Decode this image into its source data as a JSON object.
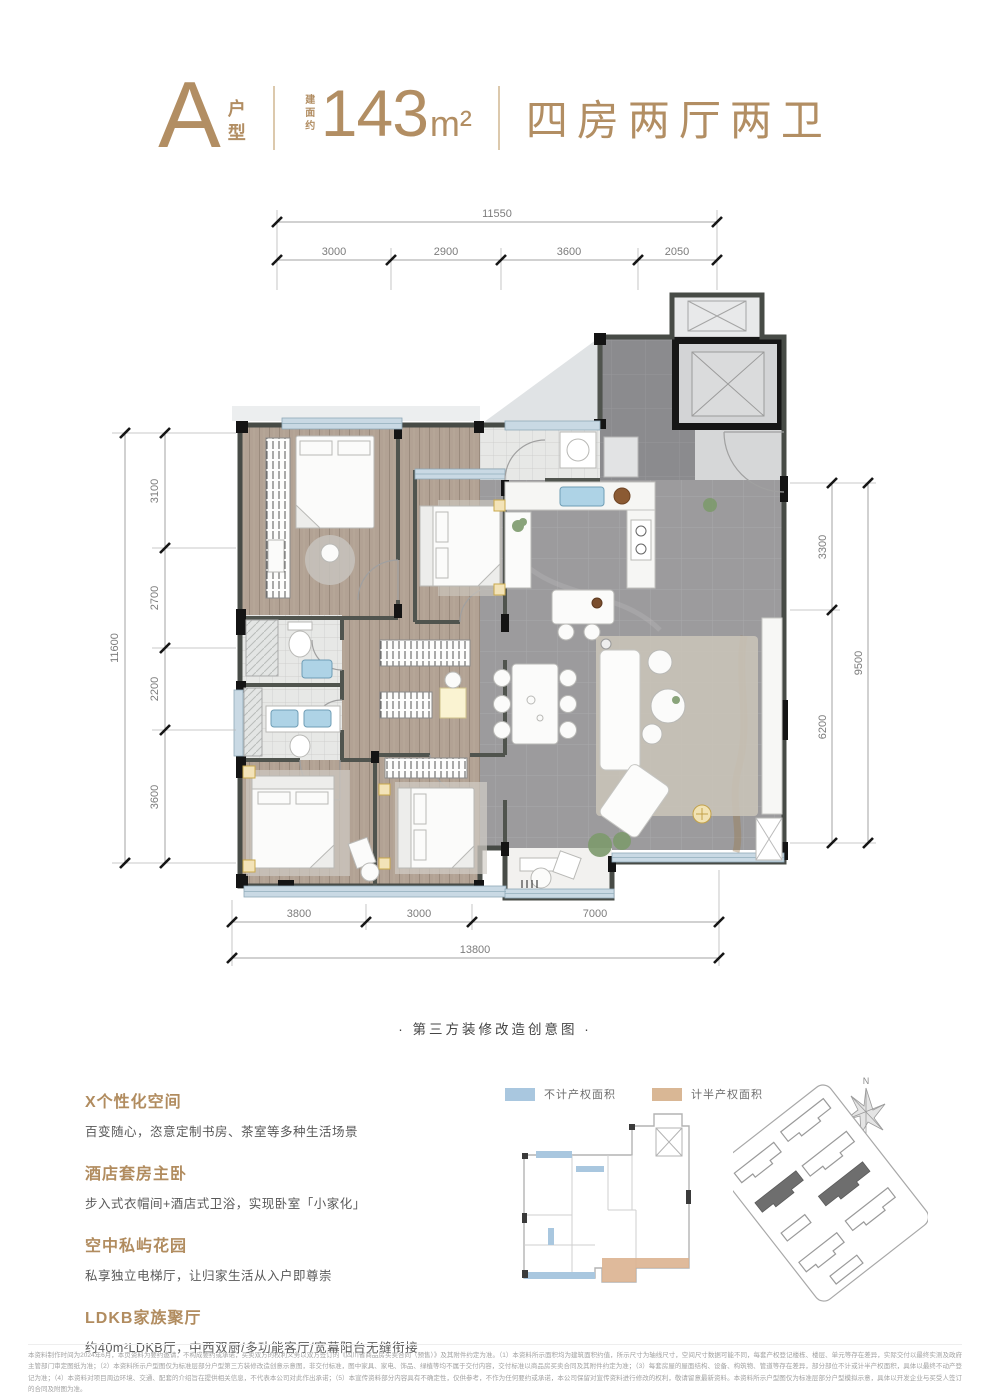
{
  "header": {
    "type_letter": "A",
    "type_word_1": "户",
    "type_word_2": "型",
    "area_prefix": "建面约",
    "area_value": "143",
    "area_unit": "m²",
    "rooms": "四房两厅两卫",
    "accent_color": "#b28e63"
  },
  "plan": {
    "caption": "· 第三方装修改造创意图 ·",
    "dims": {
      "top": {
        "total": "11550",
        "segments": [
          "3000",
          "2900",
          "3600",
          "2050"
        ]
      },
      "left": {
        "total": "11600",
        "segments": [
          "3100",
          "2700",
          "2200",
          "3600"
        ]
      },
      "right": {
        "total": "9500",
        "segments": [
          "3300",
          "6200"
        ]
      },
      "bottom": {
        "total": "13800",
        "segments": [
          "3800",
          "3000",
          "7000"
        ]
      }
    },
    "colors": {
      "wood_floor": "#b2a294",
      "marble_floor": "#9c9b9d",
      "foyer_floor": "#8b8b8e",
      "window_glazing": "#c9d9e4",
      "wall": "#474b46"
    }
  },
  "features": [
    {
      "title": "X个性化空间",
      "desc": "百变随心，恣意定制书房、茶室等多种生活场景"
    },
    {
      "title": "酒店套房主卧",
      "desc": "步入式衣帽间+酒店式卫浴，实现卧室「小家化」"
    },
    {
      "title": "空中私屿花园",
      "desc": "私享独立电梯厅，让归家生活从入户即尊崇"
    },
    {
      "title": "LDKB家族聚厅",
      "desc": "约40m²LDKB厅，中西双厨/多功能客厅/宽幕阳台无缝衔接"
    }
  ],
  "legend": [
    {
      "label": "不计产权面积",
      "color": "#a9c7df"
    },
    {
      "label": "计半产权面积",
      "color": "#d9b795"
    }
  ],
  "siteplan": {
    "compass_label": "N"
  },
  "footer": {
    "disclaimer": "本资料制作时间为2024年6月，本页资料为要约邀请，不构成要约或承诺，买卖双方的权利义务以双方签订的《四川省商品房买卖合同（预售）》及其附件约定为准。（1）本资料所示面积均为建筑面积约值，所示尺寸为轴线尺寸，空间尺寸数据可能不同，每套产权登记楼栋、楼层、单元等存在差异，实际交付以最终实测及政府主管部门审定图纸为准；（2）本资料所示户型图仅为标准层部分户型第三方装修改造创意示意图，非交付标准，图中家具、家电、饰品、绿植等均不属于交付内容，交付标准以商品房买卖合同及其附件约定为准；（3）每套房屋的屋面结构、设备、构筑物、管道等存在差异，部分部位不计或计半产权面积，具体以最终不动产登记为准；（4）本资料对项目周边环境、交通、配套的介绍旨在提供相关信息，不代表本公司对此作出承诺；（5）本宣传资料部分内容具有不确定性，仅供参考，不作为任何要约或承诺，本公司保留对宣传资料进行修改的权利，敬请留意最新资料。本资料所示户型图仅为标准层部分户型模拟示意，具体以开发企业与买受人签订的合同及附图为准。"
  }
}
